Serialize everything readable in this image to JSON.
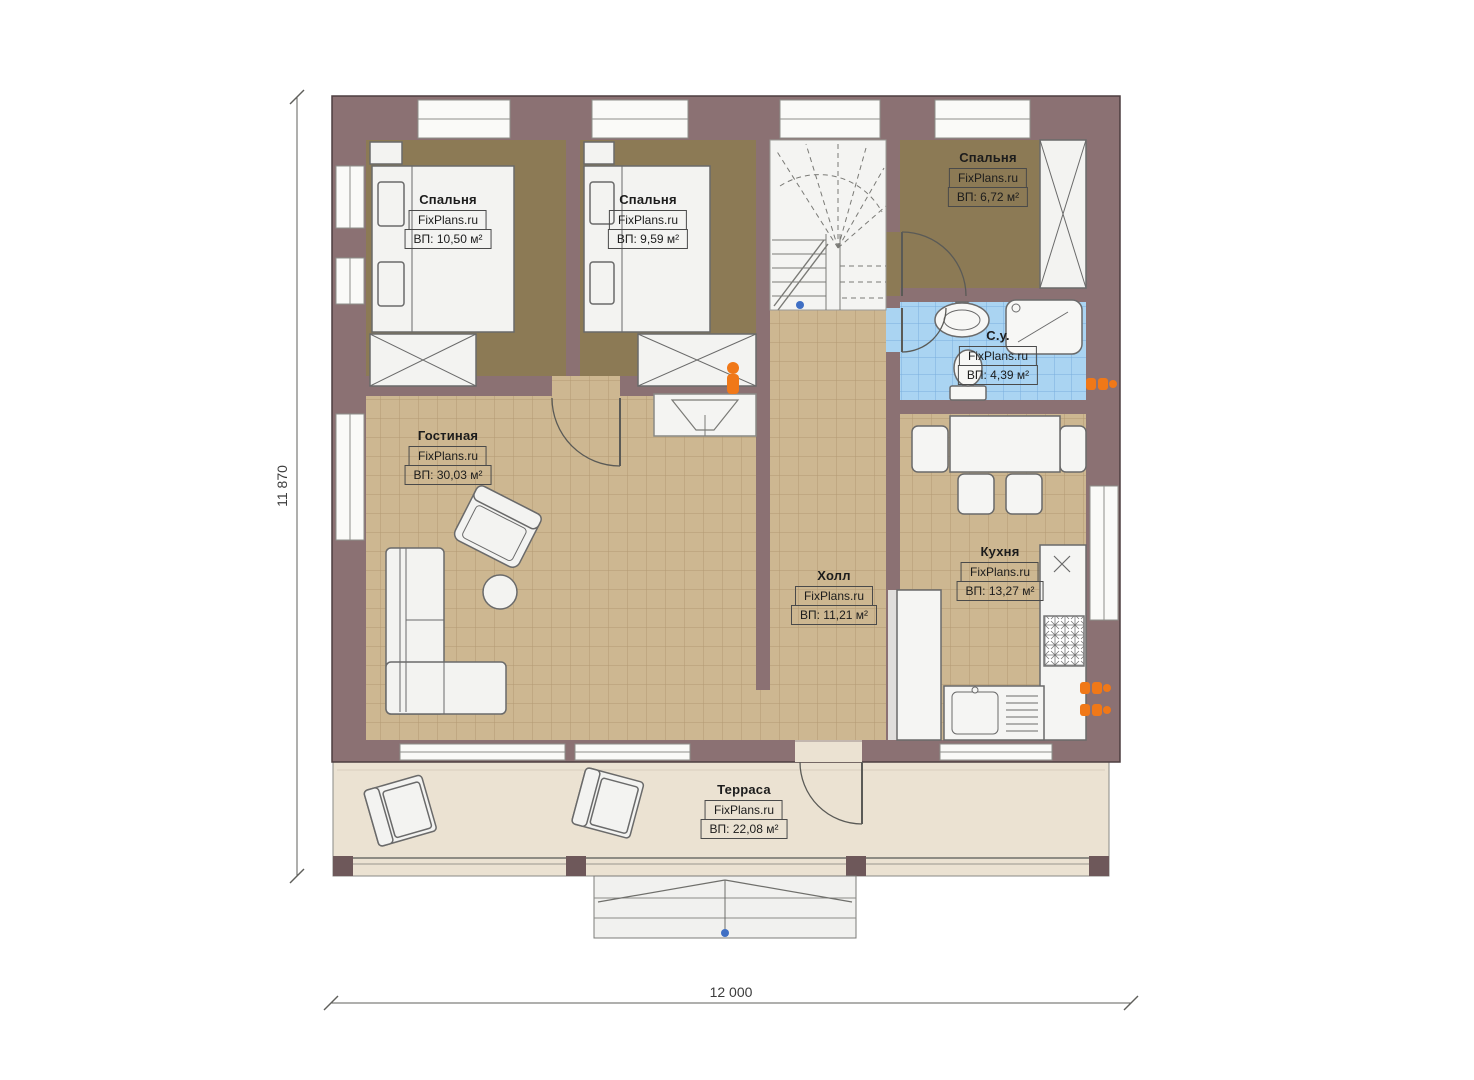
{
  "watermark": "FixPlans.ru",
  "rooms": {
    "bedroom1": {
      "name": "Спальня",
      "brand": "FixPlans.ru",
      "area": "ВП: 10,50 м²"
    },
    "bedroom2": {
      "name": "Спальня",
      "brand": "FixPlans.ru",
      "area": "ВП: 9,59 м²"
    },
    "bedroom3": {
      "name": "Спальня",
      "brand": "FixPlans.ru",
      "area": "ВП: 6,72 м²"
    },
    "bathroom": {
      "name": "С.у.",
      "brand": "FixPlans.ru",
      "area": "ВП: 4,39 м²"
    },
    "living": {
      "name": "Гостиная",
      "brand": "FixPlans.ru",
      "area": "ВП: 30,03 м²"
    },
    "hall": {
      "name": "Холл",
      "brand": "FixPlans.ru",
      "area": "ВП: 11,21 м²"
    },
    "kitchen": {
      "name": "Кухня",
      "brand": "FixPlans.ru",
      "area": "ВП: 13,27 м²"
    },
    "terrace": {
      "name": "Терраса",
      "brand": "FixPlans.ru",
      "area": "ВП: 22,08 м²"
    }
  },
  "dimensions": {
    "height": "11 870",
    "width": "12 000"
  },
  "colors": {
    "wall": "#8b7173",
    "bedroom_floor": "#8c7a55",
    "tile_floor": "#cdb791",
    "bath_floor": "#aad4f2",
    "terrace_floor": "#ebe2d2",
    "radiator": "#f07818",
    "marker_blue": "#3f6fc4"
  }
}
